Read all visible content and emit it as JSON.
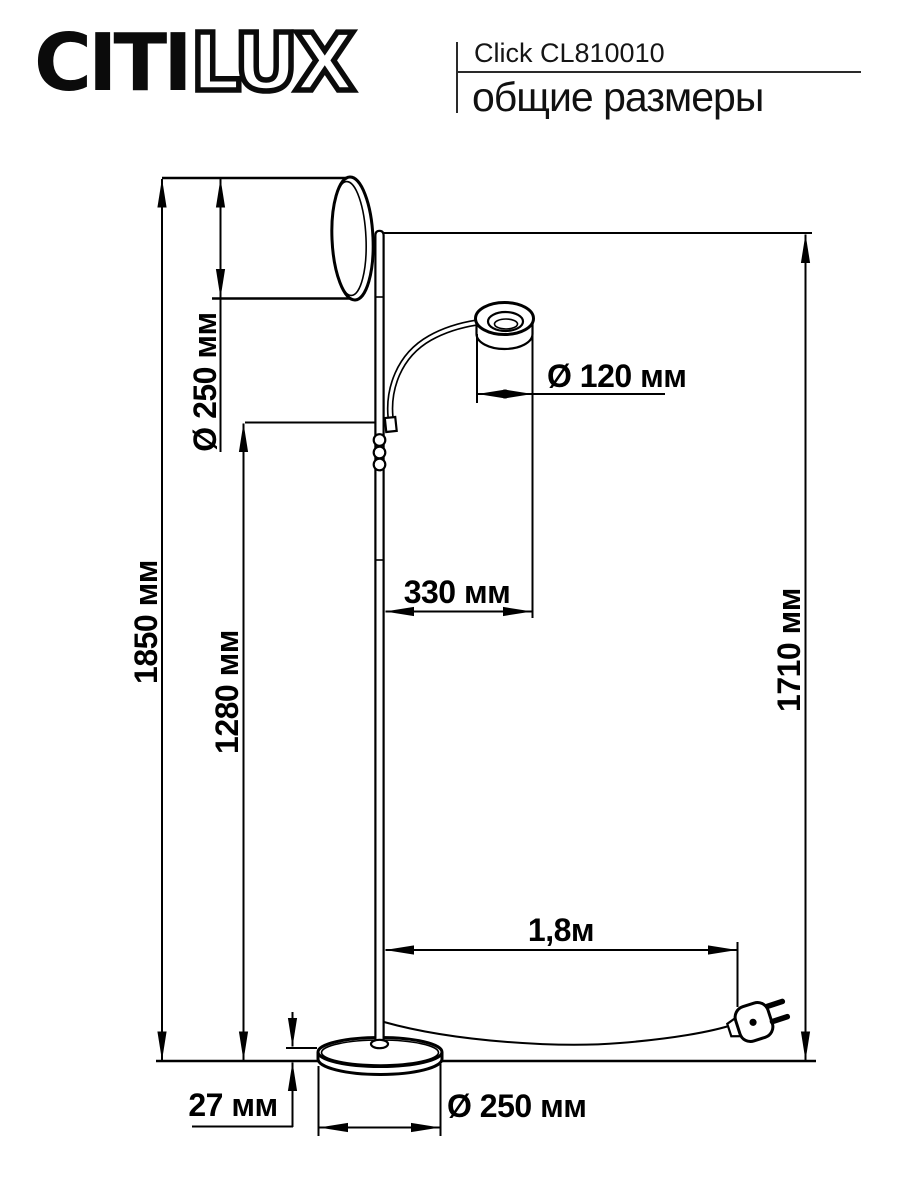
{
  "header": {
    "brand_solid": "CITI",
    "brand_outline": "LUX",
    "model": "Click CL810010",
    "subtitle": "общие размеры"
  },
  "dimensions": {
    "shade_diameter": "Ø 250 мм",
    "total_height": "1850 мм",
    "head_height": "1280 мм",
    "head_diameter": "Ø 120 мм",
    "arm_reach": "330 мм",
    "pole_height": "1710 мм",
    "cable_length": "1,8м",
    "base_height": "27 мм",
    "base_diameter": "Ø 250 мм"
  },
  "colors": {
    "line": "#000000",
    "background": "#ffffff",
    "text": "#000000"
  }
}
